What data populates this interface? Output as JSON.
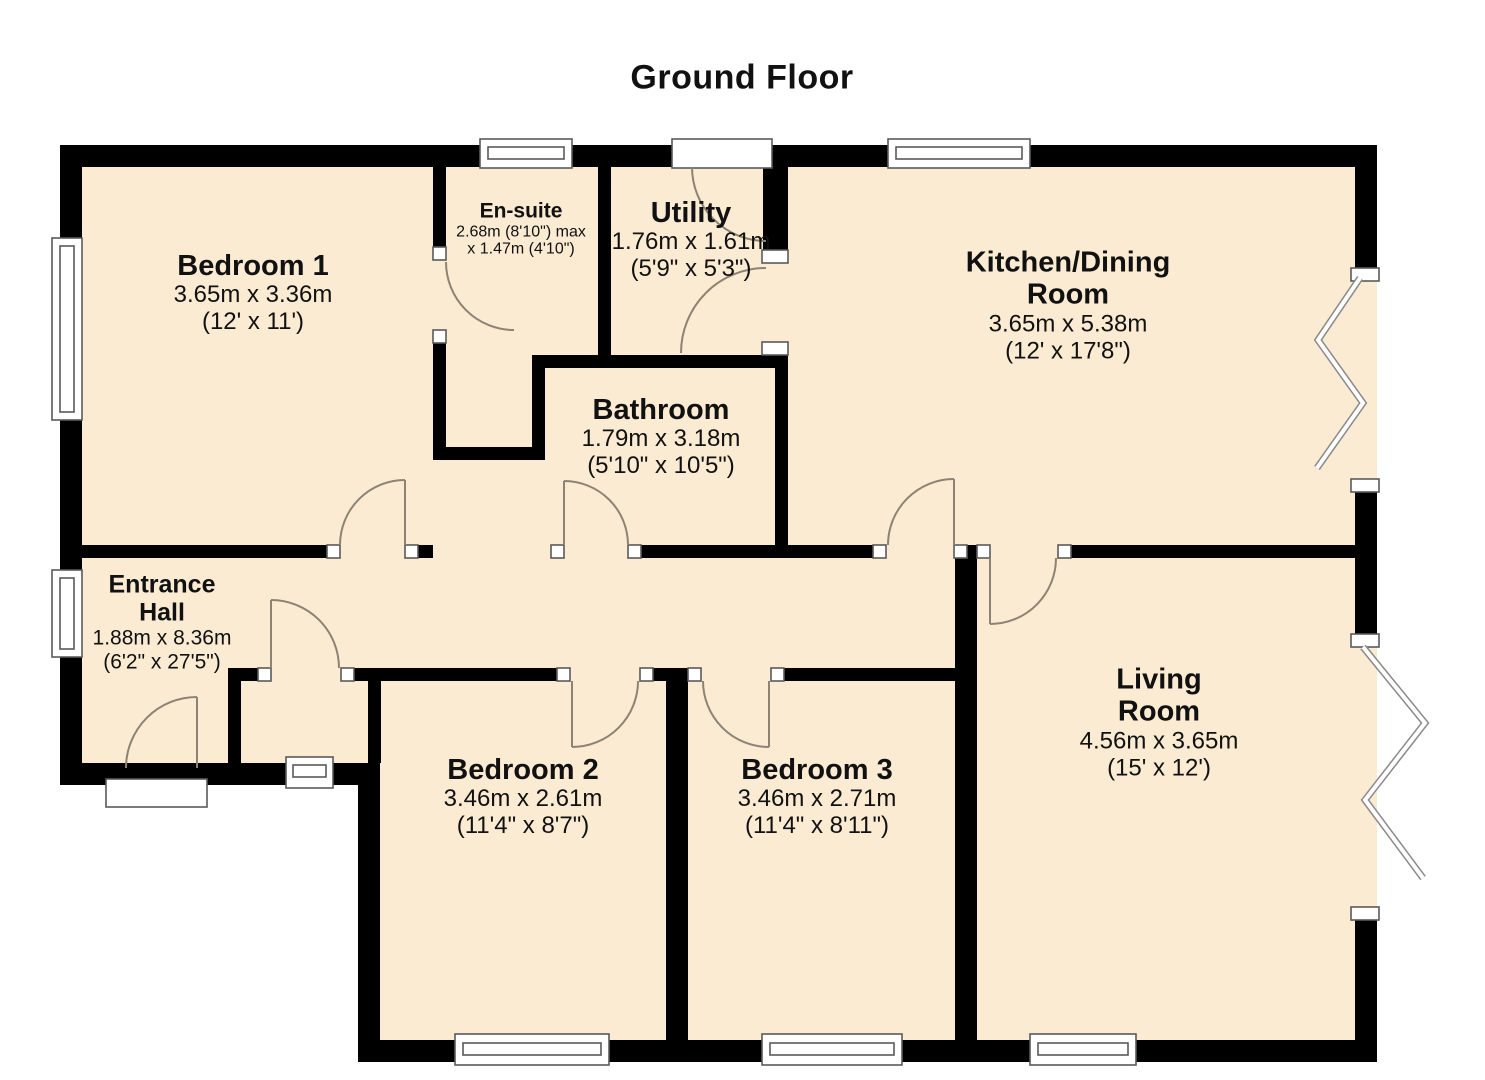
{
  "title": "Ground Floor",
  "colors": {
    "floor_fill": "#FAEBD2",
    "wall": "#000000",
    "door_arc": "#8d8374",
    "window_stroke": "#5a5a5a",
    "background": "#ffffff"
  },
  "symbols": {
    "window": "window-icon",
    "door_swing": "door-swing-icon",
    "bifold_door": "bifold-door-icon",
    "door_threshold": "door-threshold-icon"
  },
  "rooms": [
    {
      "id": "bedroom-1",
      "name_lines": [
        "Bedroom 1"
      ],
      "dim_lines": [
        "3.65m x 3.36m",
        "(12' x 11')"
      ]
    },
    {
      "id": "en-suite",
      "name_lines": [
        "En-suite"
      ],
      "dim_lines": [
        "2.68m (8'10\") max",
        "x 1.47m (4'10\")"
      ]
    },
    {
      "id": "utility",
      "name_lines": [
        "Utility"
      ],
      "dim_lines": [
        "1.76m x 1.61m",
        "(5'9\" x 5'3\")"
      ]
    },
    {
      "id": "kitchen-dining-room",
      "name_lines": [
        "Kitchen/Dining",
        "Room"
      ],
      "dim_lines": [
        "3.65m x 5.38m",
        "(12' x 17'8\")"
      ]
    },
    {
      "id": "bathroom",
      "name_lines": [
        "Bathroom"
      ],
      "dim_lines": [
        "1.79m x 3.18m",
        "(5'10\" x 10'5\")"
      ]
    },
    {
      "id": "entrance-hall",
      "name_lines": [
        "Entrance",
        "Hall"
      ],
      "dim_lines": [
        "1.88m x 8.36m",
        "(6'2\" x 27'5\")"
      ]
    },
    {
      "id": "bedroom-2",
      "name_lines": [
        "Bedroom 2"
      ],
      "dim_lines": [
        "3.46m x 2.61m",
        "(11'4\" x 8'7\")"
      ]
    },
    {
      "id": "bedroom-3",
      "name_lines": [
        "Bedroom 3"
      ],
      "dim_lines": [
        "3.46m x 2.71m",
        "(11'4\" x 8'11\")"
      ]
    },
    {
      "id": "living-room",
      "name_lines": [
        "Living",
        "Room"
      ],
      "dim_lines": [
        "4.56m x 3.65m",
        "(15' x 12')"
      ]
    }
  ]
}
